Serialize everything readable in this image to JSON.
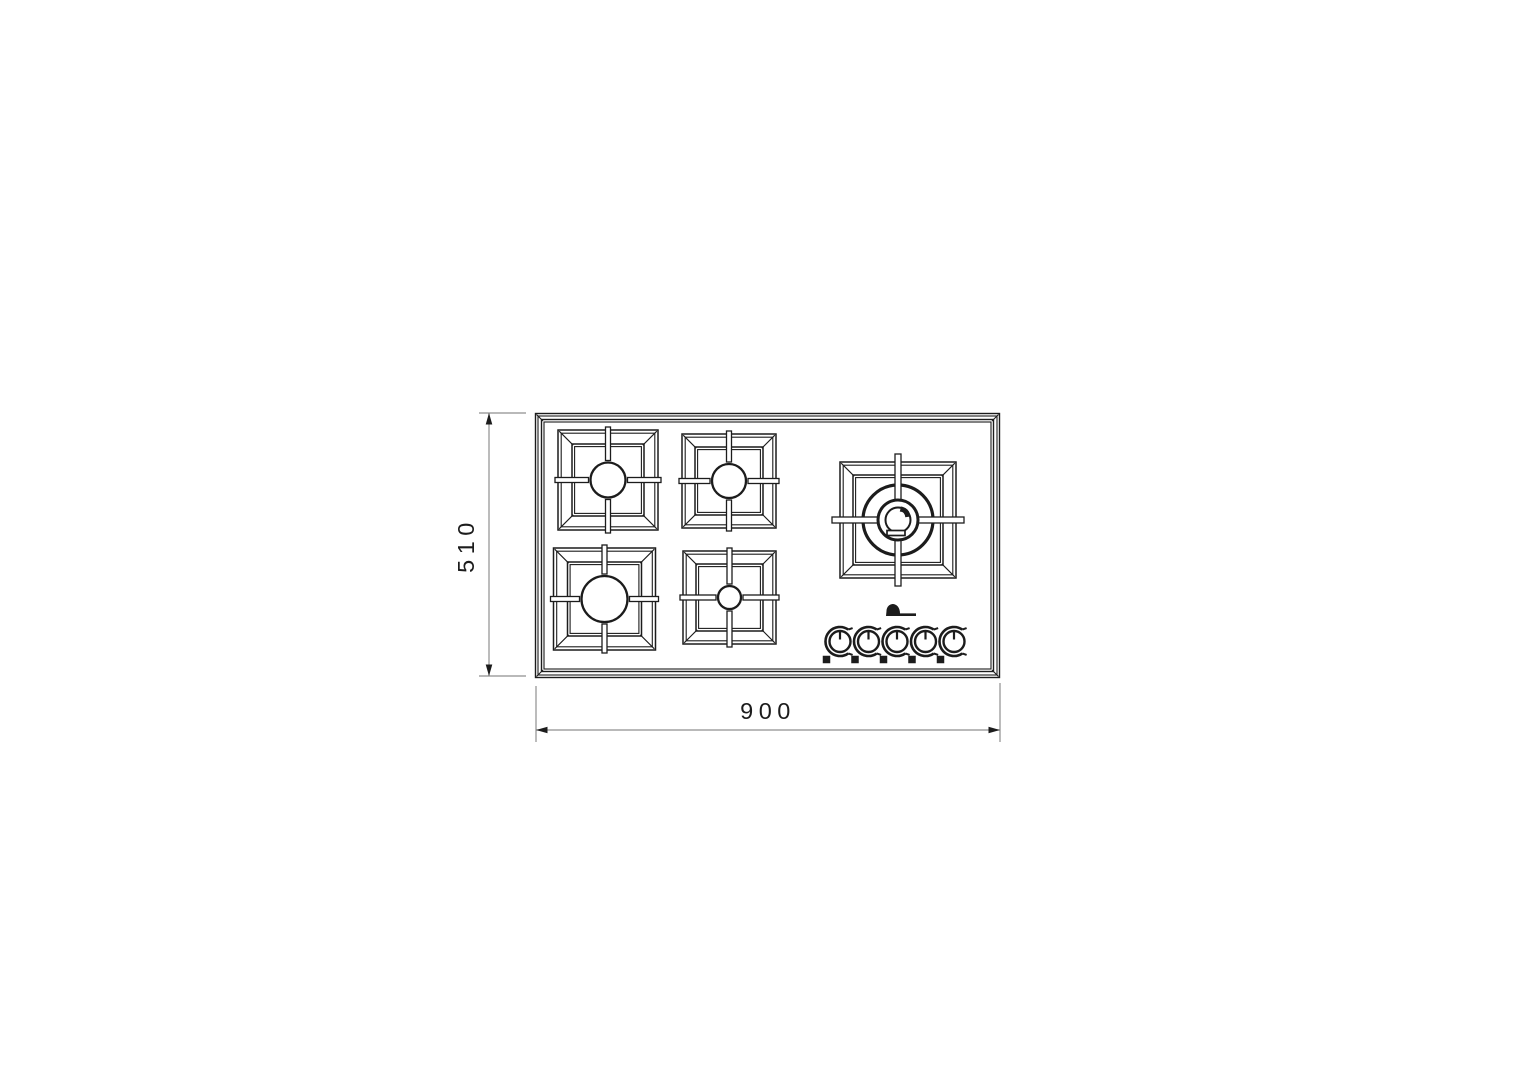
{
  "page": {
    "background_color": "#ffffff"
  },
  "drawing_meta": {
    "type": "technical-drawing",
    "line_color": "#1c1c1c",
    "dim_line_color": "#8f8f8f",
    "text_color": "#1c1c1c"
  },
  "dimensions": {
    "width": {
      "value": "900",
      "orientation": "horizontal"
    },
    "height": {
      "value": "510",
      "orientation": "vertical"
    }
  },
  "cooktop": {
    "outer": {
      "x": 535,
      "y": 413,
      "w": 465,
      "h": 265
    },
    "panel_inset": 6
  },
  "burners": [
    {
      "name": "burner-rear-left",
      "x": 558,
      "y": 430,
      "size": 100,
      "radius": 17.5,
      "inset": 14
    },
    {
      "name": "burner-rear-center",
      "x": 682,
      "y": 434,
      "size": 94,
      "radius": 17,
      "inset": 13
    },
    {
      "name": "burner-front-left",
      "x": 553.5,
      "y": 548,
      "size": 102,
      "radius": 23,
      "inset": 14
    },
    {
      "name": "burner-front-center",
      "x": 683,
      "y": 551,
      "size": 93,
      "radius": 11.5,
      "inset": 13
    }
  ],
  "wok_burner": {
    "name": "burner-wok-right",
    "x": 840,
    "y": 462,
    "size": 116,
    "inset": 13,
    "ring_radii": [
      35,
      20,
      12.5
    ],
    "bar_width": 6,
    "bar_overshoot": 8
  },
  "controls": {
    "knob_centers_x": [
      840,
      868.5,
      897,
      925.5,
      954
    ],
    "knob_y": 641.5,
    "knob_radius": 10.5,
    "arc_radius": 14.5,
    "marker_size": 7.5,
    "marker_offset_x": -13.5,
    "marker_offset_y": 18
  },
  "logo": {
    "x": 886,
    "y": 604,
    "w": 30,
    "h": 12
  },
  "dim_vertical": {
    "line_x": 489,
    "y1": 413,
    "y2": 676,
    "tick_x1": 479,
    "tick_x2": 526,
    "label_x": 466,
    "label_y": 545
  },
  "dim_horizontal": {
    "line_y": 730,
    "x1": 536,
    "x2": 1000,
    "ext_top": 686,
    "ext_bottom": 742,
    "label_x": 768,
    "label_y": 719
  }
}
